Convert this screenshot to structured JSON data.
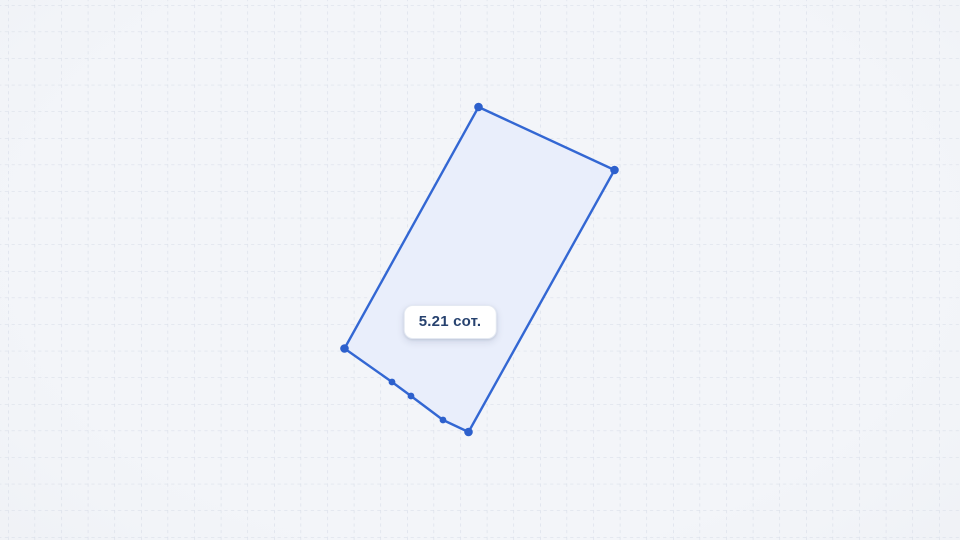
{
  "canvas": {
    "width": 960,
    "height": 540,
    "background_center_color": "#f3f5f9",
    "background_edge_color": "#e7eaef",
    "grid": {
      "spacing": 26.6,
      "offset_x": 8,
      "offset_y": 5,
      "line_color": "#d5dbe6",
      "line_width": 1.1,
      "dash_pattern": "3.2 3.4"
    }
  },
  "parcel": {
    "area_label": "5.21 сот.",
    "fill_color": "#e9eefb",
    "stroke_color": "#3367d3",
    "stroke_width": 2.4,
    "vertex_color": "#2d60cc",
    "corner_vertex_radius": 4.3,
    "edge_vertex_radius": 3.4,
    "outline": [
      [
        478.5,
        107
      ],
      [
        614.5,
        170
      ],
      [
        468.5,
        432
      ],
      [
        443,
        420
      ],
      [
        411,
        396
      ],
      [
        392,
        382
      ],
      [
        344.5,
        348.5
      ]
    ],
    "corner_vertices": [
      [
        478.5,
        107
      ],
      [
        614.5,
        170
      ],
      [
        468.5,
        432
      ],
      [
        344.5,
        348.5
      ]
    ],
    "edge_vertices": [
      [
        443,
        420
      ],
      [
        411,
        396
      ],
      [
        392,
        382
      ]
    ],
    "label_position": {
      "x": 450,
      "y": 322
    },
    "label_bg_color": "#ffffff",
    "label_text_color": "#27426f"
  }
}
